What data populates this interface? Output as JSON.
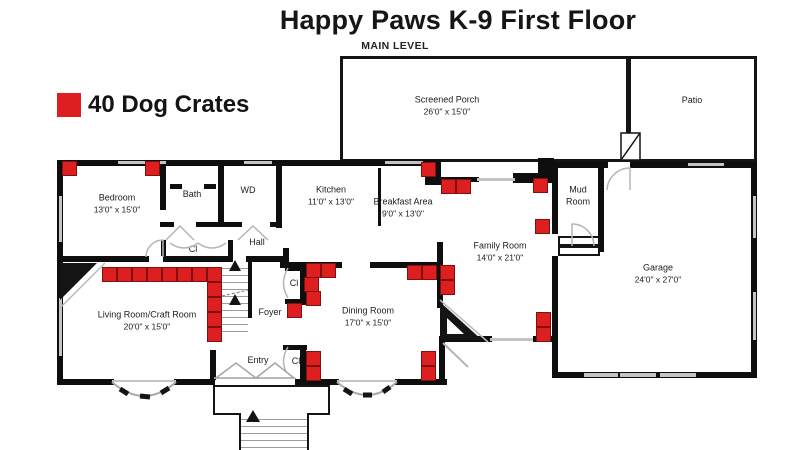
{
  "title": "Happy Paws K-9 First Floor",
  "subtitle": "MAIN LEVEL",
  "legend": {
    "count_label": "40 Dog Crates",
    "swatch_color": "#de1f1f"
  },
  "colors": {
    "crate_fill": "#de1f1f",
    "crate_border": "#801010",
    "wall": "#0e0e0e",
    "door_gray": "#b5b5b5"
  },
  "rooms": {
    "screened_porch": {
      "name": "Screened Porch",
      "dims": "26'0\" x 15'0\""
    },
    "patio": {
      "name": "Patio"
    },
    "bedroom": {
      "name": "Bedroom",
      "dims": "13'0\" x 15'0\""
    },
    "bath": {
      "name": "Bath"
    },
    "wd": {
      "name": "WD"
    },
    "hall": {
      "name": "Hall"
    },
    "closet_hall": {
      "name": "Cl"
    },
    "kitchen": {
      "name": "Kitchen",
      "dims": "11'0\" x 13'0\""
    },
    "breakfast": {
      "name": "Breakfast Area",
      "dims": "9'0\" x 13'0\""
    },
    "mud_room": {
      "name": "Mud Room"
    },
    "family_room": {
      "name": "Family Room",
      "dims": "14'0\" x 21'0\""
    },
    "garage": {
      "name": "Garage",
      "dims": "24'0\" x 27'0\""
    },
    "living_room": {
      "name": "Living Room/Craft Room",
      "dims": "20'0\" x 15'0\""
    },
    "foyer": {
      "name": "Foyer"
    },
    "dining_room": {
      "name": "Dining Room",
      "dims": "17'0\" x 15'0\""
    },
    "entry": {
      "name": "Entry"
    },
    "closet_foyer": {
      "name": "Cl"
    },
    "closet_entry": {
      "name": "Cl"
    }
  },
  "crates": {
    "size": 15,
    "positions": [
      [
        62,
        161
      ],
      [
        145,
        161
      ],
      [
        421,
        162
      ],
      [
        441,
        179
      ],
      [
        456,
        179
      ],
      [
        533,
        178
      ],
      [
        535,
        219
      ],
      [
        102,
        267
      ],
      [
        117,
        267
      ],
      [
        132,
        267
      ],
      [
        147,
        267
      ],
      [
        162,
        267
      ],
      [
        177,
        267
      ],
      [
        192,
        267
      ],
      [
        207,
        267
      ],
      [
        207,
        282
      ],
      [
        207,
        297
      ],
      [
        207,
        312
      ],
      [
        207,
        327
      ],
      [
        287,
        303
      ],
      [
        306,
        263
      ],
      [
        321,
        263
      ],
      [
        304,
        277
      ],
      [
        306,
        291
      ],
      [
        407,
        265
      ],
      [
        422,
        265
      ],
      [
        440,
        265
      ],
      [
        440,
        280
      ],
      [
        536,
        312
      ],
      [
        536,
        327
      ],
      [
        306,
        351
      ],
      [
        306,
        366
      ],
      [
        421,
        351
      ],
      [
        421,
        366
      ]
    ]
  }
}
